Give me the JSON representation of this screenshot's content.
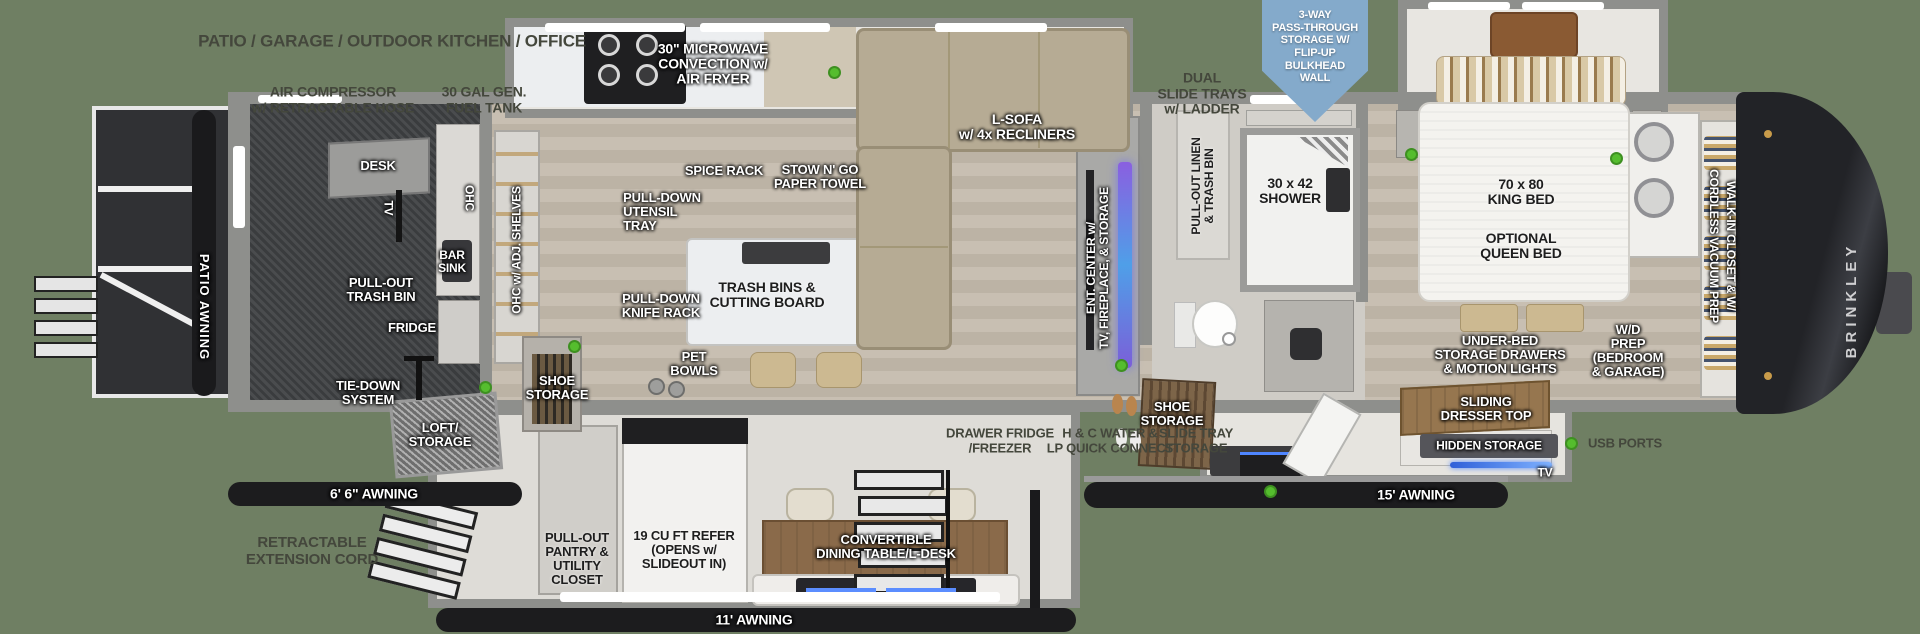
{
  "title": "Brinkley fifth wheel RV floor plan",
  "colors": {
    "background": "#6f7f63",
    "wall_gray": "#8e8f8c",
    "accent_green_dot": "#55bd2e",
    "shield_blue": "#84aacb",
    "label_gray": "#44473c",
    "fireplace_glow": "#6f74e0",
    "awning_black": "#1c1c1e"
  },
  "labels": {
    "zone_top": "PATIO / GARAGE / OUTDOOR KITCHEN / OFFICE",
    "air_compressor": "AIR COMPRESSOR\nw/ RETRACTABLE HOSE",
    "fuel_tank": "30 GAL GEN.\nFUEL TANK",
    "dual_slide_trays": "DUAL\nSLIDE TRAYS\nw/ LADDER",
    "shield": "3-WAY\nPASS-THROUGH\nSTORAGE W/\nFLIP-UP\nBULKHEAD\nWALL",
    "microwave": "30\" MICROWAVE\nCONVECTION w/\nAIR FRYER",
    "l_sofa": "L-SOFA\nw/ 4x RECLINERS",
    "spice_rack": "SPICE RACK",
    "stow_n_go": "STOW N' GO\nPAPER TOWEL",
    "utensil_tray": "PULL-DOWN\nUTENSIL\nTRAY",
    "knife_rack": "PULL-DOWN\nKNIFE RACK",
    "island": "TRASH BINS &\nCUTTING BOARD",
    "pet_bowls": "PET\nBOWLS",
    "shoe_storage_kitchen": "SHOE\nSTORAGE",
    "loft_storage": "LOFT/\nSTORAGE",
    "tie_down": "TIE-DOWN\nSYSTEM",
    "fridge": "FRIDGE",
    "pull_out_trash": "PULL-OUT\nTRASH BIN",
    "desk": "DESK",
    "tv_garage": "TV",
    "bar_sink": "BAR\nSINK",
    "ohc": "OHC",
    "ohc_adj_shelves": "OHC w/ ADJ. SHELVES",
    "patio_awning": "PATIO AWNING",
    "ent_center": "ENT. CENTER w/\nTV, FIREPLACE, & STORAGE",
    "shower": "30 x 42\nSHOWER",
    "linen": "PULL-OUT LINEN\n& TRASH BIN",
    "shoe_storage_bath": "SHOE\nSTORAGE",
    "king_bed": "70 x 80\nKING BED",
    "queen_bed": "OPTIONAL\nQUEEN BED",
    "under_bed": "UNDER-BED\nSTORAGE DRAWERS\n& MOTION LIGHTS",
    "sliding_dresser": "SLIDING\nDRESSER TOP",
    "hidden_storage": "HIDDEN STORAGE",
    "tv_bedroom": "TV",
    "wd_prep": "W/D\nPREP\n(BEDROOM\n& GARAGE)",
    "walk_in_closet": "WALK-IN CLOSET & W/\nCORDLESS VACUUM PREP",
    "brinkley": "BRINKLEY",
    "awning_66": "6' 6\" AWNING",
    "awning_11": "11' AWNING",
    "awning_15": "15' AWNING",
    "retractable_cord": "RETRACTABLE\nEXTENSION CORD",
    "pantry": "PULL-OUT\nPANTRY &\nUTILITY\nCLOSET",
    "refer": "19 CU FT REFER\n(OPENS w/\nSLIDEOUT IN)",
    "dining": "CONVERTIBLE\nDINING TABLE/L-DESK",
    "drawer_fridge": "DRAWER FRIDGE\n/FREEZER",
    "hc_water": "H & C WATER &\nLP QUICK CONNECT",
    "slide_tray_storage": "SLIDE TRAY\nSTORAGE",
    "usb_ports": "USB PORTS"
  }
}
